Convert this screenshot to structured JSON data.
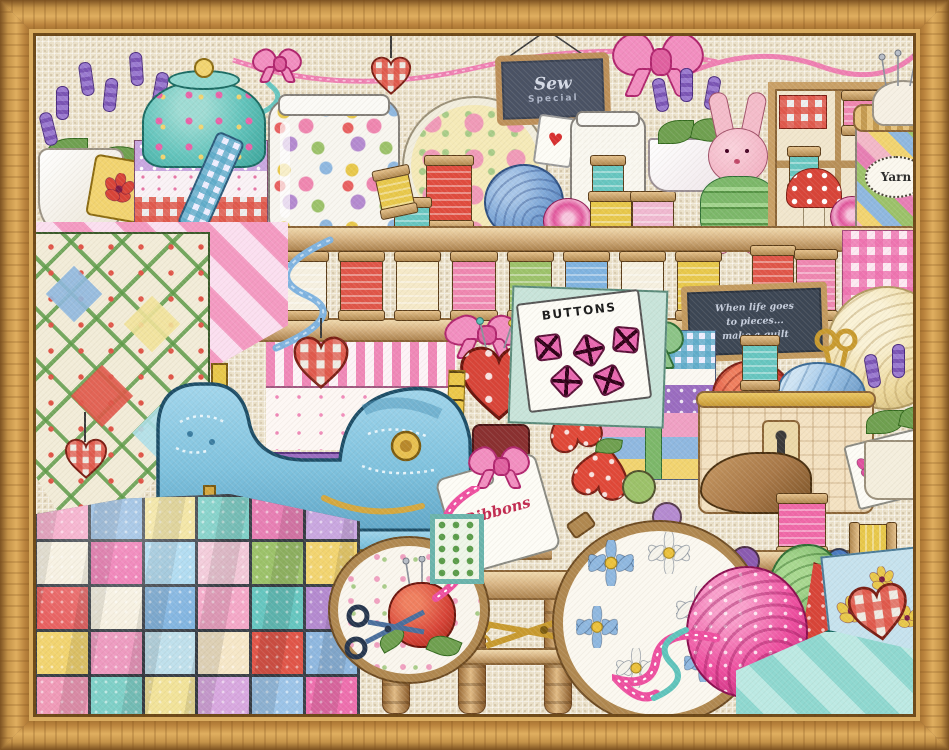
{
  "artwork": {
    "type": "framed counted cross-stitch sampler",
    "scene": "sewing room shelves with notions, quilts, thread spools and a blue sewing machine"
  },
  "texts": {
    "hanging_sign": {
      "line1": "Sew",
      "line2": "Special"
    },
    "chalkboard": {
      "line1": "When life goes",
      "line2": "to pieces...",
      "line3": "make a quilt"
    },
    "yarn_jar_label": "Yarn",
    "buttons_card_label": "BUTTONS",
    "ribbons_tag_label": "Ribbons",
    "heart_glyph": "♥"
  },
  "palette": {
    "frame_oak": "#c59349",
    "cloth": "#ece2cb",
    "shelf_wood": "#d9b686",
    "machine_blue": "#7fc2de",
    "accent_pink": "#ee6fae",
    "accent_red": "#dc4a3a",
    "accent_teal": "#66c6c0",
    "accent_lavender": "#8d6fc4",
    "chalkboard_bg": "#3c4654",
    "gold": "#d4a840"
  },
  "quilt_patches": [
    "#f4a8c8",
    "#8fb8e0",
    "#f2e39a",
    "#7fd0c8",
    "#e77fb4",
    "#c9a7e0",
    "#f6f0e0",
    "#ee6fae",
    "#a8d8f0",
    "#f2c8d8",
    "#9cc26a",
    "#f2d470",
    "#e86060",
    "#f6f0e0",
    "#7fb3e0",
    "#f4a8c8",
    "#66c6c0",
    "#b48ad0",
    "#f2d470",
    "#ee9ac0",
    "#bfe0ec",
    "#f6e7c8",
    "#e05548",
    "#8fb8e0",
    "#f09ab8",
    "#7fd0c8",
    "#f2e39a",
    "#d8a8e0",
    "#9cc4e8",
    "#ee6fae"
  ],
  "spool_threads": [
    "#f6f0e0",
    "#e05548",
    "#f5e9c8",
    "#ef86b0",
    "#9cc26a",
    "#7fb3e0",
    "#f6f0e0",
    "#e8c84a"
  ]
}
